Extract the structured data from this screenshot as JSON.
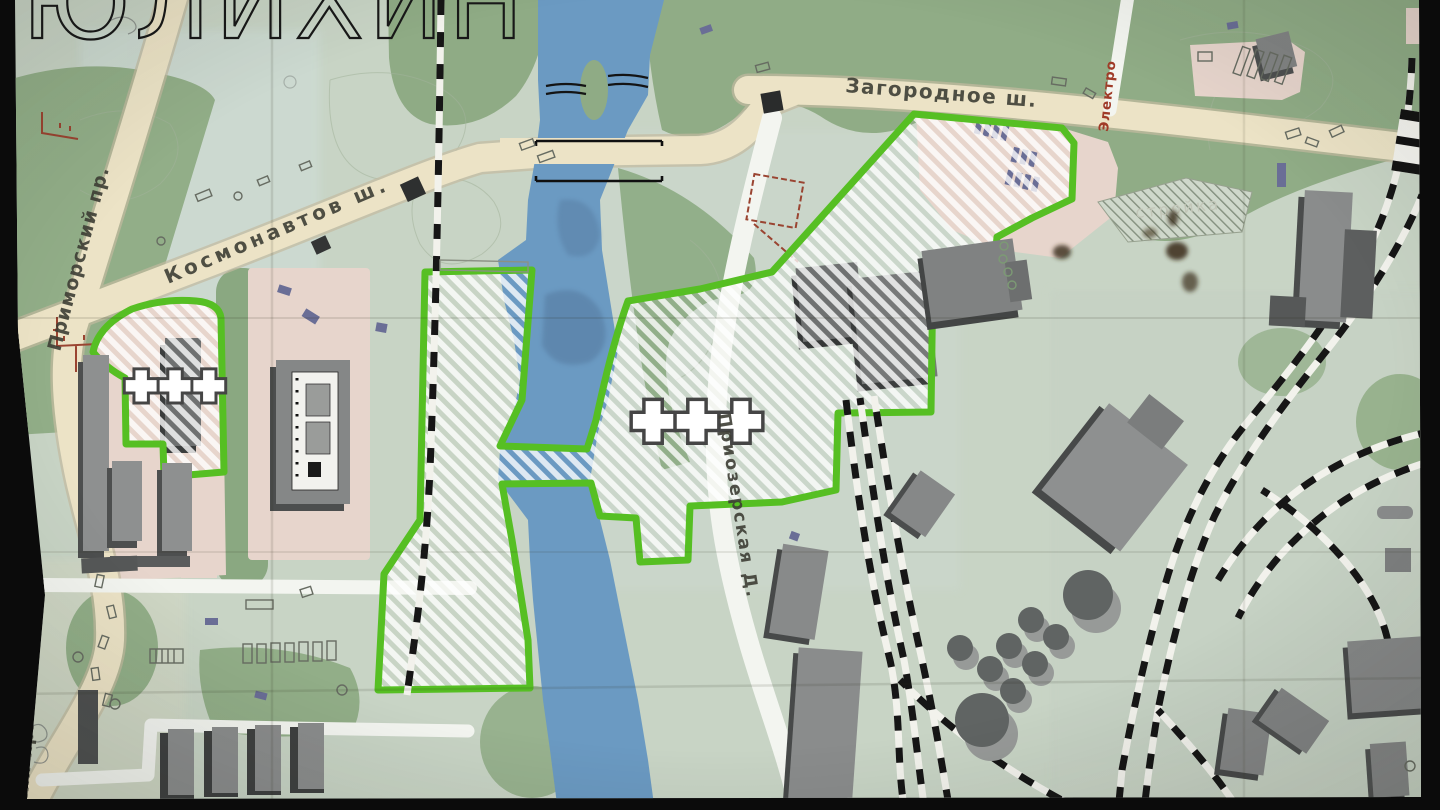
{
  "window": {
    "letterbox_color": "#0b0b0b"
  },
  "map": {
    "big_title_partial": "ЮЛИХИН",
    "street_labels": {
      "primorsky": "Приморский пр.",
      "primorsky_clipped": "кий пр.",
      "kosmonavtov": "Космонавтов ш.",
      "zagorodnoe": "Загородное ш.",
      "priozerskaya": "Приозерская Д.",
      "elektro": "Электро"
    },
    "area_labels": {
      "construction": "стройка"
    },
    "zone_markers": {
      "west_zone": "+++",
      "central_zone": "+++"
    },
    "palette": {
      "paper": "#c8d4c5",
      "park_green": "#92ae88",
      "road_beige": "#ece3c6",
      "road_white": "#f3f5f0",
      "river_blue": "#6b9ac2",
      "zone_outline_green": "#56bf23",
      "building_side": "#4d4f4f",
      "building_top": "#8e9090",
      "pink_block": "#e7d5cc",
      "accent_red": "#9a4431",
      "car_purple": "#6a6e96",
      "rail_black": "#161616"
    }
  }
}
